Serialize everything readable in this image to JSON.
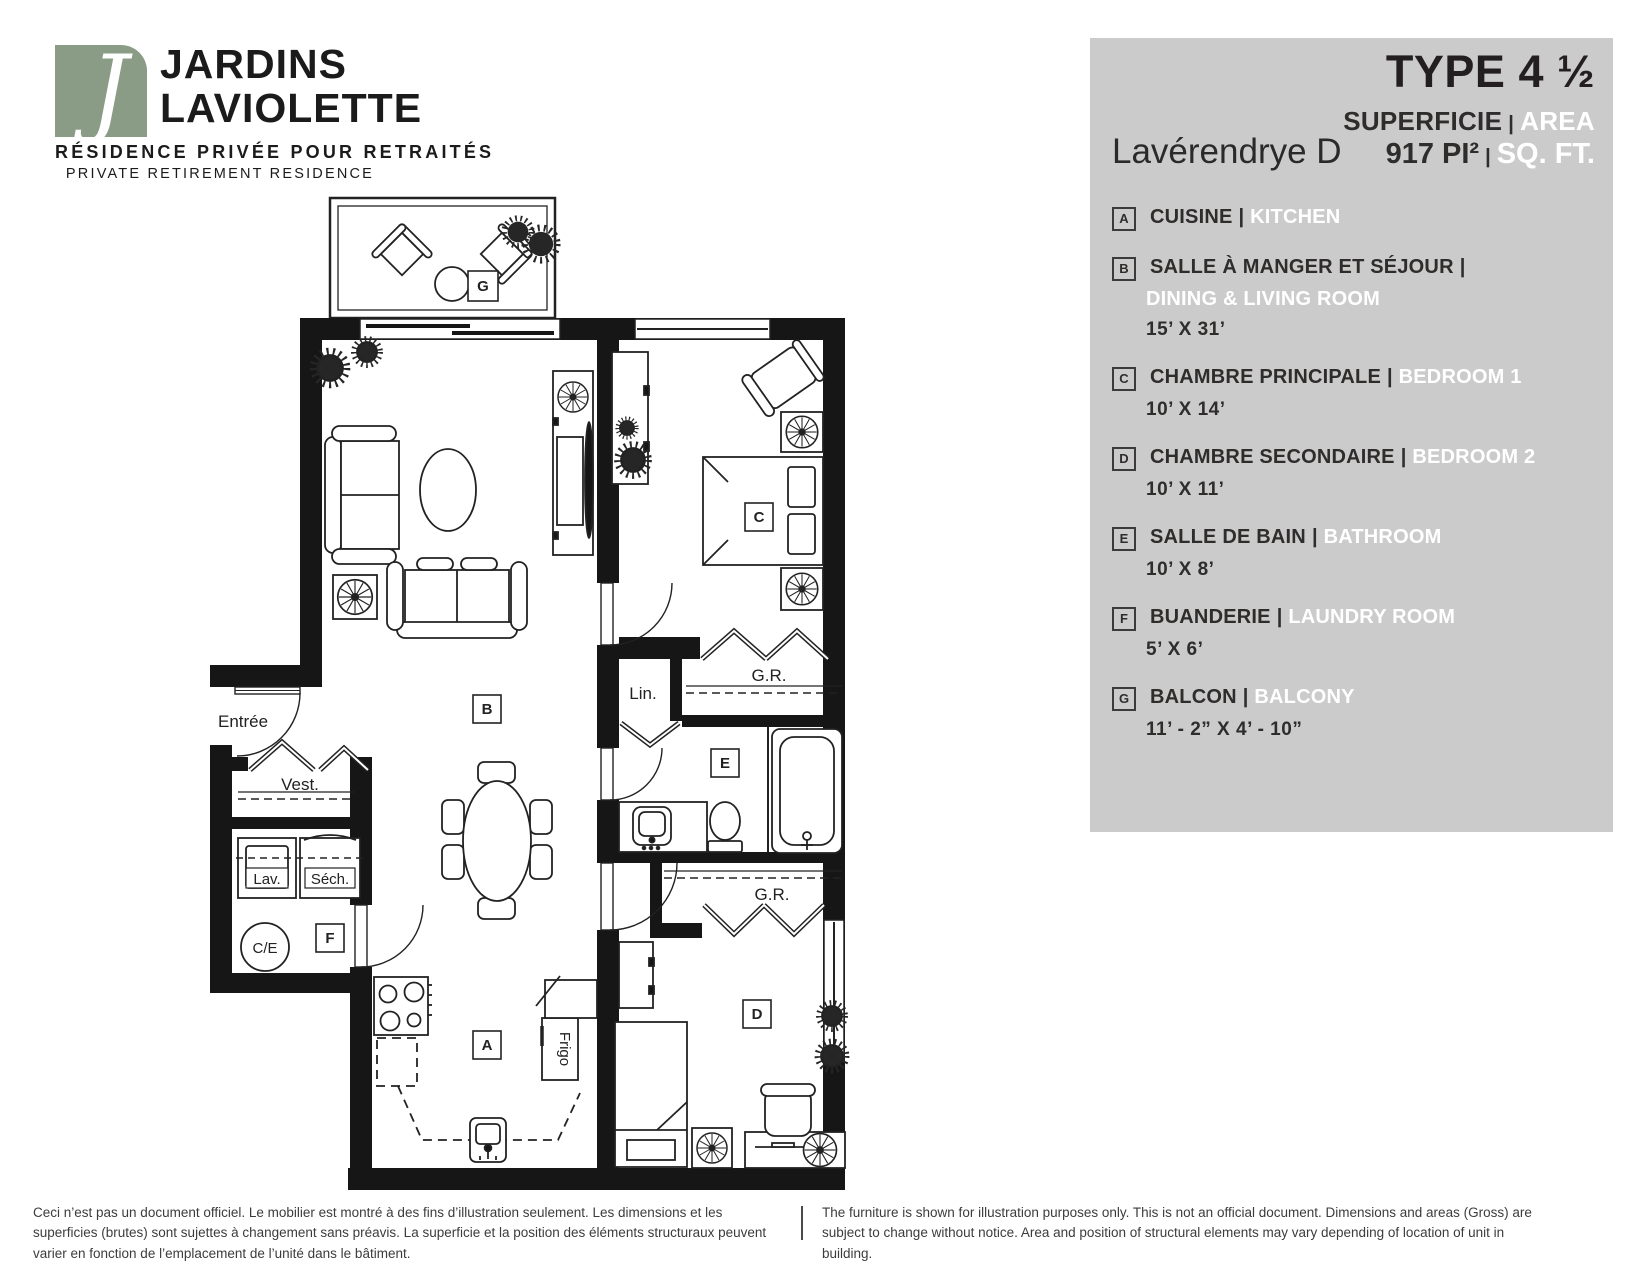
{
  "logo": {
    "monogram": "J",
    "brand_line1": "JARDINS",
    "brand_line2": "LAVIOLETTE",
    "tagline_fr": "RÉSIDENCE PRIVÉE POUR RETRAITÉS",
    "tagline_en": "PRIVATE RETIREMENT RESIDENCE",
    "brand_green": "#8a9c85"
  },
  "header": {
    "type_label": "TYPE 4 ½",
    "superficie_fr": "SUPERFICIE",
    "superficie_en": "AREA",
    "unit_name": "Lavérendrye D",
    "area_value": "917 PI²",
    "area_unit_en": "SQ. FT.",
    "separator": "|",
    "panel_gray": "#cccbcb",
    "white": "#ffffff"
  },
  "legend": {
    "separator": "|",
    "items": [
      {
        "key": "A",
        "fr": "CUISINE",
        "en": "KITCHEN",
        "dim": ""
      },
      {
        "key": "B",
        "fr": "SALLE À MANGER ET SÉJOUR",
        "en": "DINING & LIVING ROOM",
        "dim": "15’ X 31’"
      },
      {
        "key": "C",
        "fr": "CHAMBRE PRINCIPALE",
        "en": "BEDROOM 1",
        "dim": "10’ X 14’"
      },
      {
        "key": "D",
        "fr": "CHAMBRE SECONDAIRE",
        "en": "BEDROOM 2",
        "dim": "10’ X 11’"
      },
      {
        "key": "E",
        "fr": "SALLE DE BAIN",
        "en": "BATHROOM",
        "dim": "10’ X 8’"
      },
      {
        "key": "F",
        "fr": "BUANDERIE",
        "en": "LAUNDRY ROOM",
        "dim": "5’ X 6’"
      },
      {
        "key": "G",
        "fr": "BALCON",
        "en": "BALCONY",
        "dim": "11’ - 2” X 4’ - 10”"
      }
    ]
  },
  "plan": {
    "rooms": {
      "a": "A",
      "b": "B",
      "c": "C",
      "d": "D",
      "e": "E",
      "f": "F",
      "g": "G"
    },
    "labels": {
      "entree": "Entrée",
      "vest": "Vest.",
      "lav": "Lav.",
      "sech": "Séch.",
      "ce": "C/E",
      "lin": "Lin.",
      "gr1": "G.R.",
      "gr2": "G.R.",
      "frigo": "Frigo"
    }
  },
  "footer": {
    "fr": "Ceci n’est pas un document officiel. Le mobilier est montré à des fins d’illustration seulement. Les dimensions et les superficies (brutes) sont sujettes à changement sans préavis. La superficie et la position des éléments structuraux peuvent varier en fonction de l’emplacement de l’unité dans le bâtiment.",
    "en": "The furniture is shown for illustration purposes only. This is not an official document. Dimensions and areas (Gross) are subject to change without notice. Area and position of structural elements may vary depending of location of unit in building."
  }
}
